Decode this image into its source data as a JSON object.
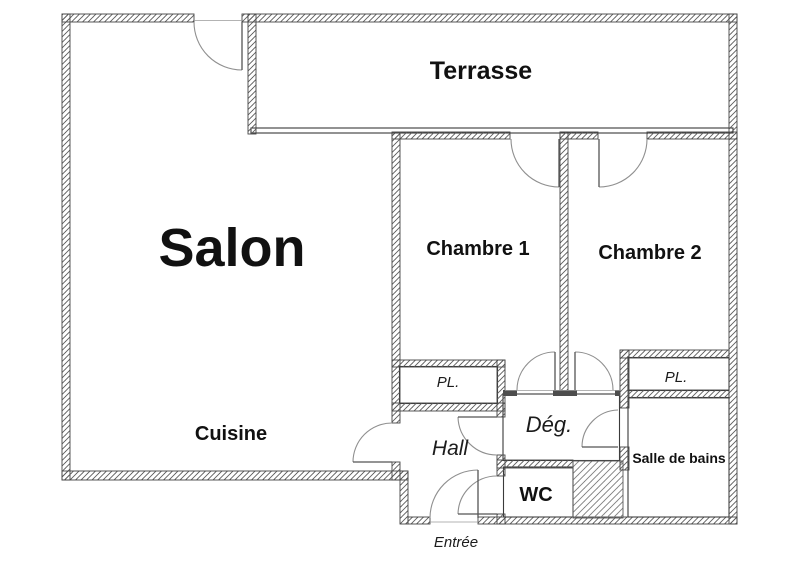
{
  "plan": {
    "type": "apartment-floor-plan",
    "labels": {
      "salon": "Salon",
      "terrasse": "Terrasse",
      "chambre1": "Chambre 1",
      "chambre2": "Chambre 2",
      "cuisine": "Cuisine",
      "pl_left": "PL.",
      "pl_right": "PL.",
      "hall": "Hall",
      "deg": "Dég.",
      "wc": "WC",
      "salle_de_bains": "Salle de bains",
      "entree": "Entrée"
    },
    "colors": {
      "background": "#ffffff",
      "wall_hatch": "#5a5a5a",
      "wall_outline": "#454545",
      "door_arc": "#8f8f8f",
      "door_leaf": "#555555",
      "text": "#111111"
    }
  }
}
